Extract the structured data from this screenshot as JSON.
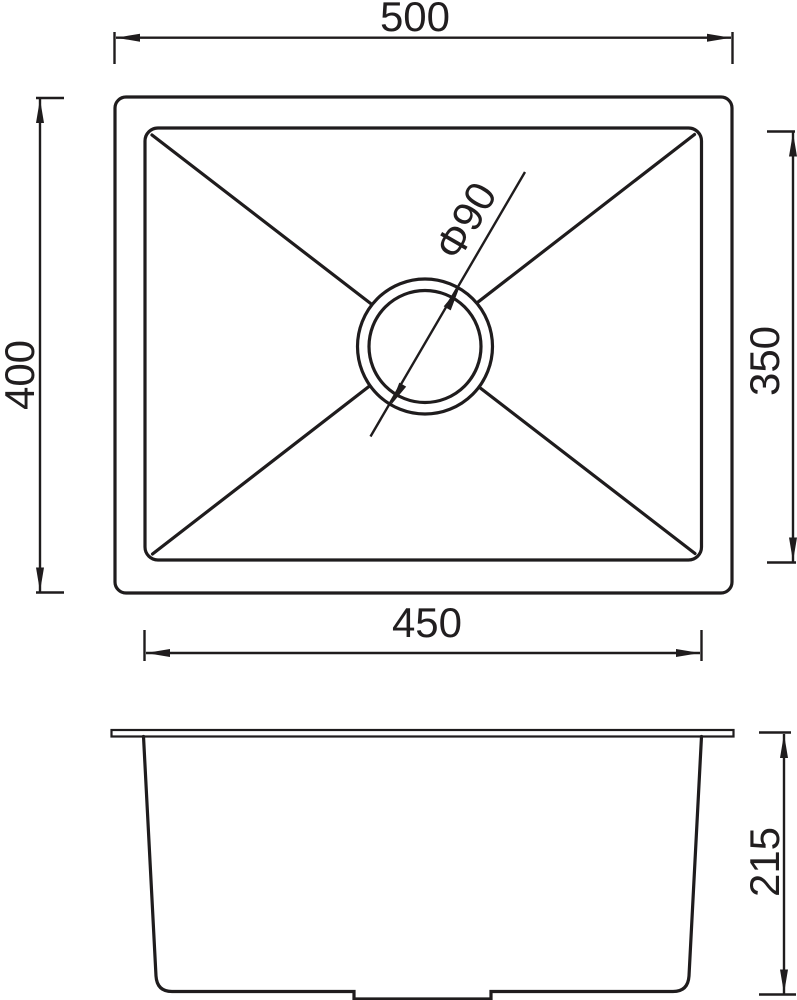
{
  "colors": {
    "background": "#ffffff",
    "line": "#1f1c1d",
    "text": "#211e1f"
  },
  "top_view": {
    "dim_outer_width_label": "500",
    "dim_outer_height_label": "400",
    "dim_inner_width_label": "450",
    "dim_inner_height_label": "350",
    "dim_drain_diameter_label": "Φ90"
  },
  "side_view": {
    "dim_depth_label": "215"
  }
}
